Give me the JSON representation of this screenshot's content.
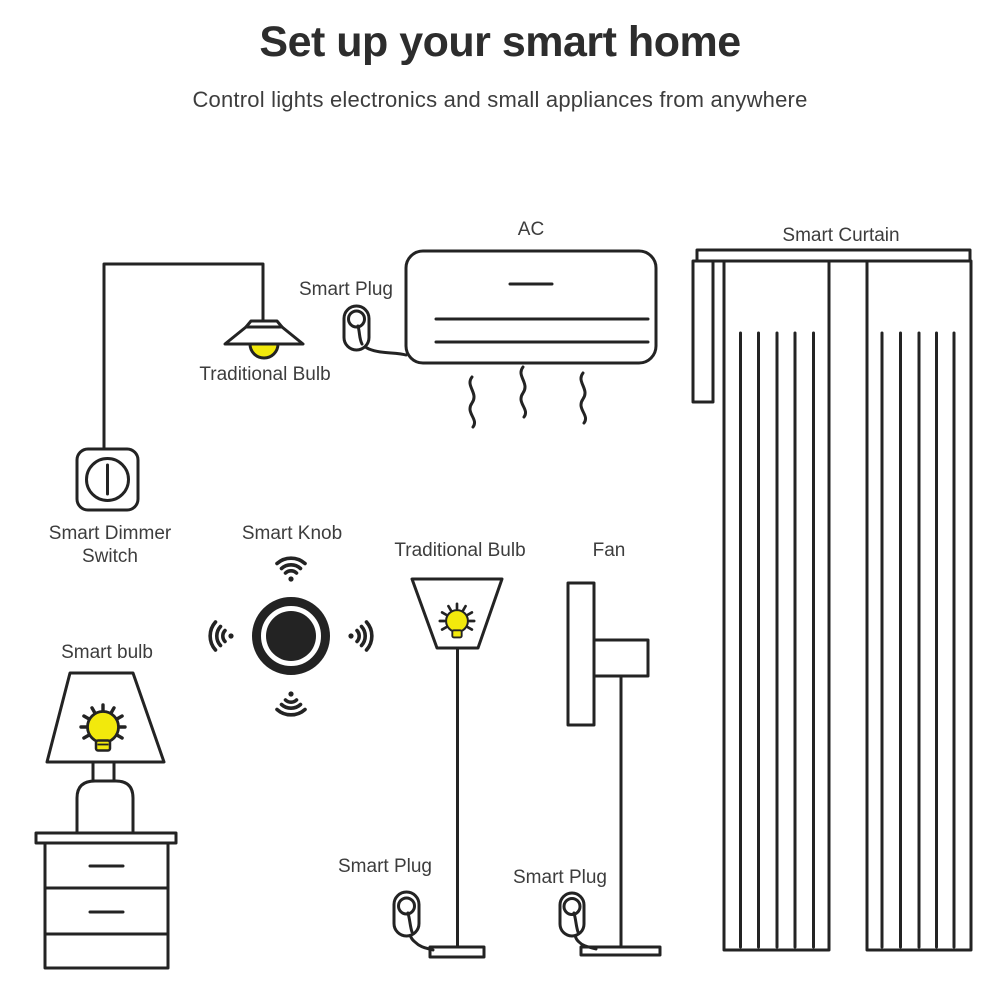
{
  "header": {
    "title": "Set up your smart home",
    "subtitle": "Control lights electronics and small appliances from anywhere"
  },
  "labels": {
    "ac": "AC",
    "smart_curtain": "Smart Curtain",
    "smart_plug_ac": "Smart Plug",
    "pendant_bulb": "Traditional Bulb",
    "dimmer_line1": "Smart Dimmer",
    "dimmer_line2": "Switch",
    "smart_knob": "Smart Knob",
    "floor_bulb": "Traditional Bulb",
    "fan": "Fan",
    "smart_bulb": "Smart bulb",
    "smart_plug_lamp": "Smart Plug",
    "smart_plug_fan": "Smart Plug"
  },
  "colors": {
    "line": "#232323",
    "text": "#3d3d3d",
    "title": "#2d2d2d",
    "bulb_yellow": "#f2e90c",
    "background": "#ffffff"
  }
}
